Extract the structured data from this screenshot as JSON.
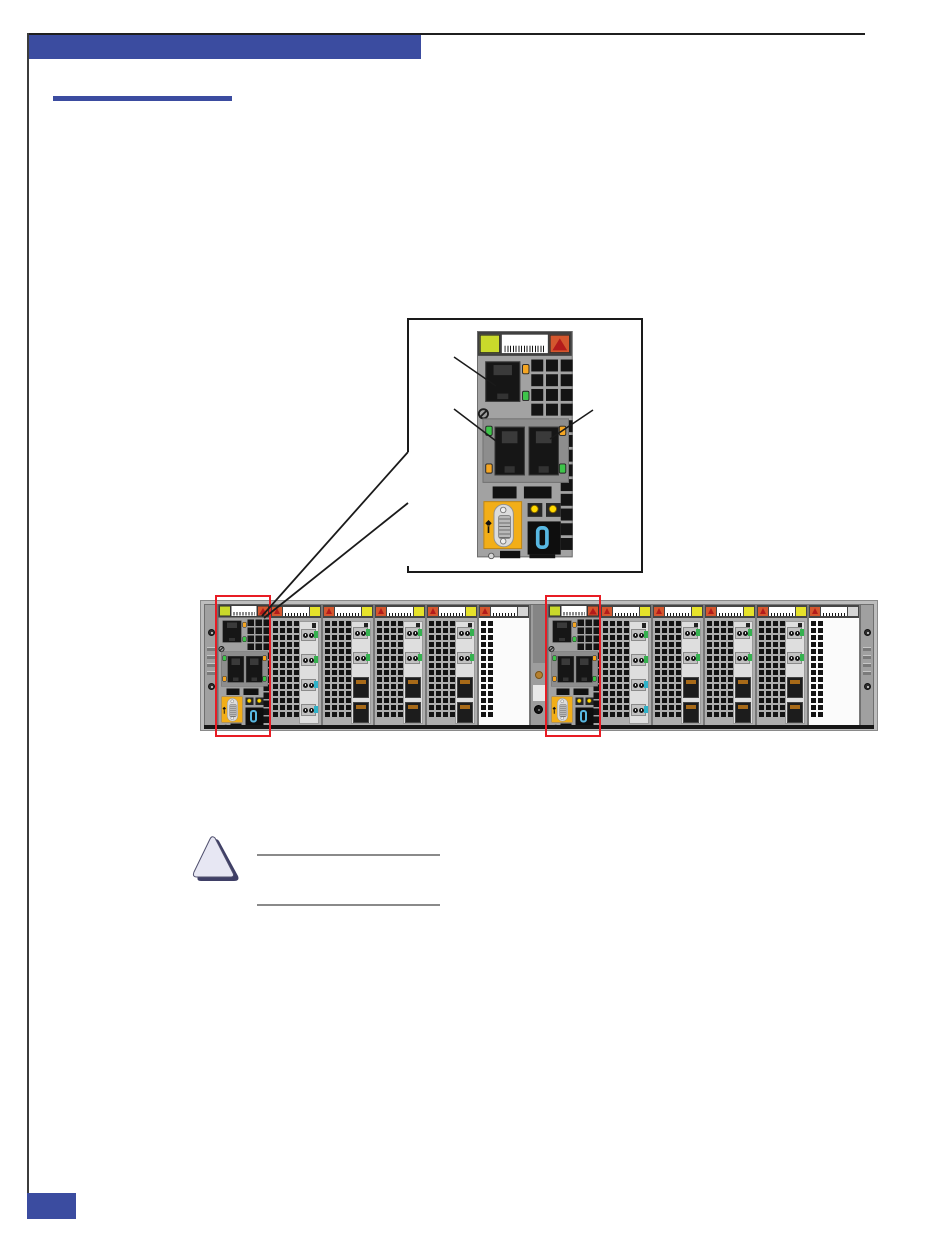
{
  "page": {
    "kind": "hardware-manual-figure-page",
    "background": "#ffffff",
    "header_bar_text": "",
    "page_marker_text": ""
  },
  "colors": {
    "accent": "#3b4ca0",
    "module_header": "#3f3f3f",
    "chassis_frame": "#bdbdbd",
    "panel_recess": "#8d8d8d",
    "vent": "#141414",
    "green_square": "#c9d92b",
    "yellow_square": "#e6e22a",
    "warn_orange": "#d4572e",
    "warn_red": "#b31b1b",
    "led_amber": "#f5a623",
    "led_green": "#3ec44a",
    "led_yellow": "#ffd900",
    "serial_panel": "#f2ae18",
    "display_blue": "#58b8e2",
    "lc_tag_green": "#35b14f",
    "lc_tag_cyan": "#2fb3c9",
    "highlight_red": "#e81c24",
    "note_rule": "#8a8a8a",
    "caution_fill": "#e7e7f3",
    "caution_shadow": "#3f3f66"
  },
  "callout": {
    "subject": "management-controller-module-detail",
    "status_display_digit": "0",
    "pointer_lines": [
      "service-ethernet-port",
      "lan-ethernet-port-left",
      "lan-ethernet-port-right"
    ]
  },
  "chassis": {
    "status_display_digit": "0",
    "halves": [
      {
        "side": "left",
        "slots": [
          {
            "type": "controller",
            "highlighted": true
          },
          {
            "type": "fiber-quad"
          },
          {
            "type": "fiber-combo"
          },
          {
            "type": "fiber-combo"
          },
          {
            "type": "fiber-combo"
          },
          {
            "type": "filler"
          }
        ]
      },
      {
        "side": "right",
        "slots": [
          {
            "type": "controller",
            "highlighted": true
          },
          {
            "type": "fiber-quad"
          },
          {
            "type": "fiber-combo"
          },
          {
            "type": "fiber-combo"
          },
          {
            "type": "fiber-combo"
          },
          {
            "type": "filler"
          }
        ]
      }
    ]
  },
  "note": {
    "icon": "caution-triangle-icon",
    "text_lines": [
      "",
      ""
    ]
  }
}
